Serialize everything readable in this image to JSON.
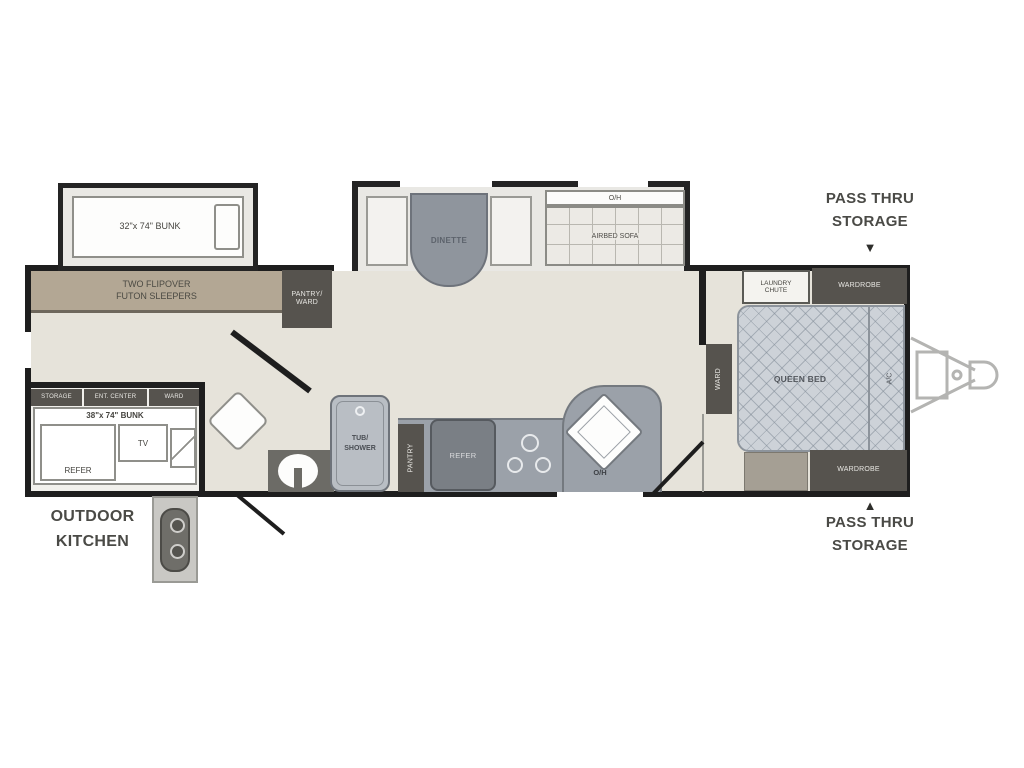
{
  "labels": {
    "front_bunk": "32\"x 74\" BUNK",
    "futon": {
      "line1": "TWO FLIPOVER",
      "line2": "FUTON SLEEPERS"
    },
    "pantry_ward": {
      "line1": "PANTRY/",
      "line2": "WARD"
    },
    "dinette": "DINETTE",
    "sofa": {
      "oh": "O/H",
      "name": "AIRBED SOFA"
    },
    "laundry": {
      "line1": "LAUNDRY",
      "line2": "CHUTE"
    },
    "wardrobe_top": "WARDROBE",
    "bed": {
      "name": "QUEEN BED",
      "ac": "A/C",
      "ward": "WARD"
    },
    "wardrobe_bottom": "WARDROBE",
    "pass_thru_top": {
      "line1": "PASS THRU",
      "line2": "STORAGE",
      "arrow": "▼"
    },
    "pass_thru_bottom": {
      "arrow": "▲",
      "line1": "PASS THRU",
      "line2": "STORAGE"
    },
    "cabinet_row": [
      "STORAGE",
      "ENT. CENTER",
      "WARD"
    ],
    "rear_bunk": "38\"x 74\" BUNK",
    "refer_left": "REFER",
    "tv": "TV",
    "outdoor": {
      "line1": "OUTDOOR",
      "line2": "KITCHEN"
    },
    "bath": {
      "tub1": "TUB/",
      "tub2": "SHOWER"
    },
    "kitchen": {
      "pantry": "PANTRY",
      "refer": "REFER",
      "oh": "O/H"
    }
  },
  "colors": {
    "wall": "#1e1e1e",
    "floor": "#e6e3da",
    "slide_floor": "#e9e8e4",
    "bench_tan": "#b3a794",
    "dark_cabinet": "#56534e",
    "counter_gray": "#9ba1a9",
    "table_gray": "#8f959d",
    "bed_fill": "#cdd2d8",
    "label_text": "#4a4a46"
  }
}
